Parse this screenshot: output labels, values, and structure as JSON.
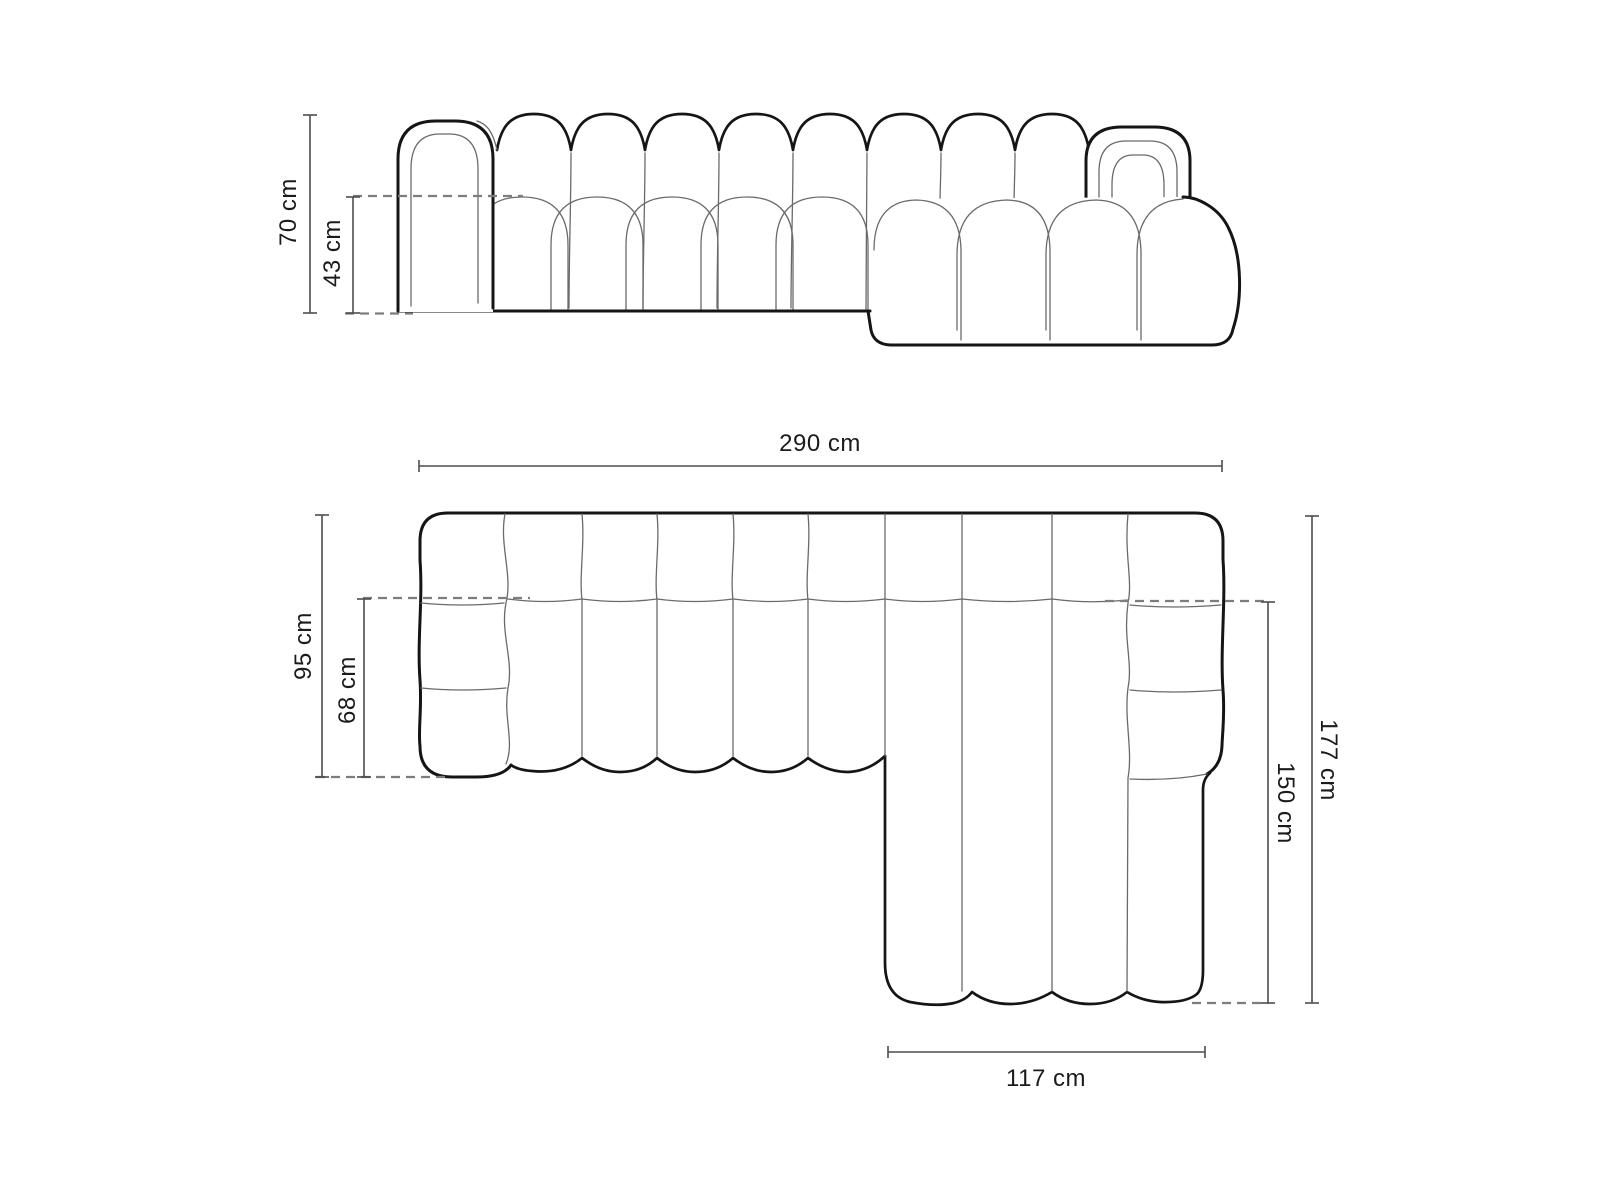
{
  "diagram": {
    "type": "sofa-dimension-diagram",
    "product": "modular chaise sectional sofa",
    "colors": {
      "background": "#ffffff",
      "outline": "#151515",
      "thin_line": "#6a6a6a",
      "dimension_line": "#4d4d4d",
      "dashed_line": "#7d7d7d",
      "text": "#1b1b1b"
    },
    "views": {
      "front": {
        "name": "front-elevation",
        "dims": {
          "total_height": "70 cm",
          "seat_height": "43 cm"
        }
      },
      "top": {
        "name": "top-plan",
        "dims": {
          "total_width": "290 cm",
          "depth": "95 cm",
          "seat_depth": "68 cm",
          "total_depth": "177 cm",
          "chaise_length": "150 cm",
          "chaise_width": "117 cm"
        }
      }
    }
  }
}
